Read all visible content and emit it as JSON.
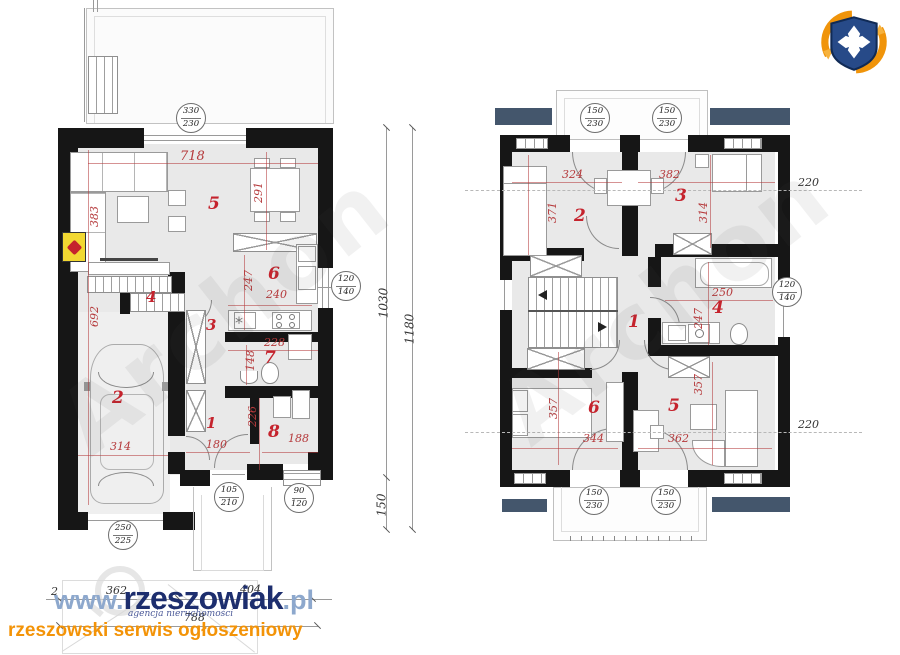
{
  "branding": {
    "www": "www.",
    "name": "rzeszowiak",
    "tld": ".pl",
    "subtitle": "agencja nieruchomości",
    "tagline": "rzeszowski serwis ogłoszeniowy"
  },
  "watermark": {
    "text": "Archon"
  },
  "icons": {
    "sink": "*"
  },
  "chains": {
    "inner": "1030",
    "outer": "1180",
    "seg": "150",
    "b1": "2",
    "b2": "362",
    "b3": "404",
    "b4": "788"
  },
  "heights": {
    "t": "220",
    "b": "220"
  },
  "ground": {
    "rooms": [
      "1",
      "2",
      "3",
      "4",
      "5",
      "6",
      "7",
      "8"
    ],
    "dims": {
      "d718": "718",
      "d291": "291",
      "d383": "383",
      "d692": "692",
      "d247": "247",
      "d240": "240",
      "d228": "228",
      "d148": "148",
      "d180": "180",
      "d226": "226",
      "d188": "188",
      "d314": "314"
    },
    "c0": {
      "a": "330",
      "b": "230"
    },
    "c1": {
      "a": "120",
      "b": "140"
    },
    "c2": {
      "a": "105",
      "b": "210"
    },
    "c3": {
      "a": "90",
      "b": "120"
    },
    "c4": {
      "a": "250",
      "b": "225"
    }
  },
  "first": {
    "rooms": [
      "1",
      "2",
      "3",
      "4",
      "5",
      "6"
    ],
    "dims": {
      "d324": "324",
      "d382": "382",
      "d371": "371",
      "d314": "314",
      "d250": "250",
      "d247": "247",
      "d357a": "357",
      "d357b": "357",
      "d344": "344",
      "d362": "362"
    },
    "c0": {
      "a": "150",
      "b": "230"
    },
    "c1": {
      "a": "150",
      "b": "230"
    },
    "c2": {
      "a": "150",
      "b": "230"
    },
    "c3": {
      "a": "150",
      "b": "230"
    },
    "c4": {
      "a": "120",
      "b": "140"
    }
  }
}
